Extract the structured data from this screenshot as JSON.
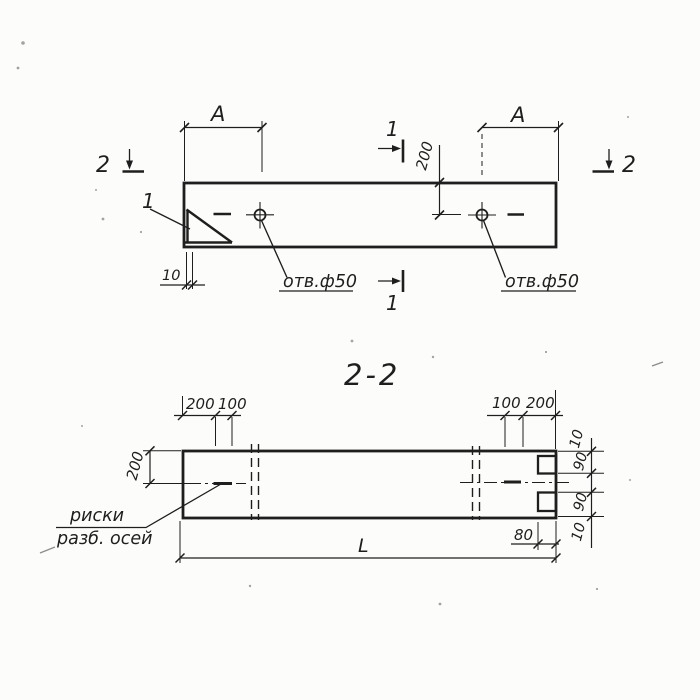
{
  "plan_view": {
    "span_dim": "A",
    "half_width_dim": "200",
    "edge_offset_dim": "10",
    "hole_note": "отв.ф50",
    "detail_ref": "1",
    "section_cut_1": "1",
    "section_cut_2": "2"
  },
  "section_view": {
    "title": "2-2",
    "top_left_dims": [
      "200",
      "100"
    ],
    "top_right_dims": [
      "100",
      "200"
    ],
    "half_height_dim": "200",
    "right_dims": [
      "10",
      "90",
      "90",
      "10"
    ],
    "notch_depth_dim": "80",
    "length_dim": "L",
    "axis_note": [
      "риски",
      "разб. осей"
    ]
  },
  "colors": {
    "ink": "#1e1e1e",
    "paper": "#fcfcfa"
  }
}
